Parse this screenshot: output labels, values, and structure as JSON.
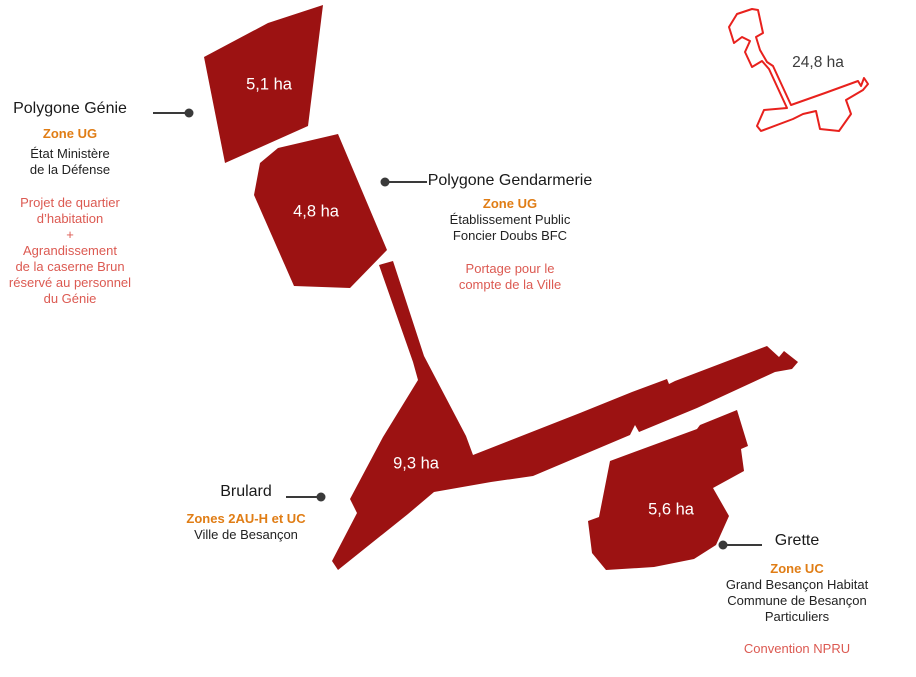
{
  "colors": {
    "parcel_fill": "#9C1212",
    "overview_outline": "#E8211D",
    "zone_orange": "#E07D15",
    "note_red": "#DC5A52",
    "text_dark": "#1A1A1A",
    "leader_gray": "#3A3A3A",
    "area_label_white": "#FFFFFF"
  },
  "parcels": {
    "genie": {
      "title": "Polygone Génie",
      "zone": "Zone UG",
      "owner_lines": [
        "État Ministère",
        "de la Défense"
      ],
      "note_lines": [
        "Projet de quartier",
        "d’habitation",
        "+",
        "Agrandissement",
        "de la caserne Brun",
        "réservé au personnel",
        "du Génie"
      ],
      "area": "5,1 ha"
    },
    "gendarmerie": {
      "title": "Polygone Gendarmerie",
      "zone": "Zone UG",
      "owner_lines": [
        "Établissement Public",
        "Foncier Doubs BFC"
      ],
      "note_lines": [
        "Portage pour le",
        "compte de la Ville"
      ],
      "area": "4,8 ha"
    },
    "brulard": {
      "title": "Brulard",
      "zone": "Zones 2AU-H et UC",
      "owner_lines": [
        "Ville de Besançon"
      ],
      "area": "9,3 ha"
    },
    "grette": {
      "title": "Grette",
      "zone": "Zone UC",
      "owner_lines": [
        "Grand Besançon Habitat",
        "Commune de Besançon",
        "Particuliers"
      ],
      "note_lines": [
        "Convention NPRU"
      ],
      "area": "5,6 ha"
    }
  },
  "overview": {
    "area": "24,8 ha"
  }
}
